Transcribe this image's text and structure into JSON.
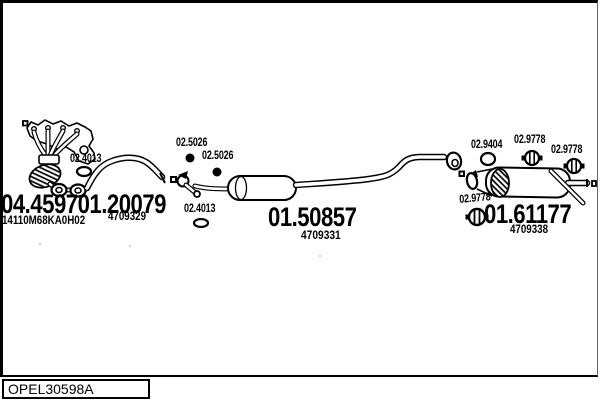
{
  "diagram": {
    "type": "exhaust-system-parts-diagram",
    "colors": {
      "line": "#000000",
      "background": "#ffffff"
    },
    "parts": {
      "front_section": {
        "part_number_a": "04.45970",
        "part_number_b": "1.20079",
        "oem_code": "14110M68KA0H02",
        "ref_code": "4709329"
      },
      "centre_silencer": {
        "part_number": "01.50857",
        "ref_code": "4709331"
      },
      "rear_silencer": {
        "part_number": "01.61177",
        "ref_code": "4709338"
      }
    },
    "hardware_labels": [
      {
        "id": "gasket-front",
        "text": "02.4013"
      },
      {
        "id": "mount-a",
        "text": "02.5026"
      },
      {
        "id": "mount-b",
        "text": "02.5026"
      },
      {
        "id": "gasket-mid",
        "text": "02.4013"
      },
      {
        "id": "ring-gasket",
        "text": "02.9404"
      },
      {
        "id": "hanger-a",
        "text": "02.9778"
      },
      {
        "id": "hanger-b",
        "text": "02.9778"
      },
      {
        "id": "hanger-c",
        "text": "02.9778"
      }
    ],
    "footer": {
      "code": "OPEL30598A"
    }
  }
}
